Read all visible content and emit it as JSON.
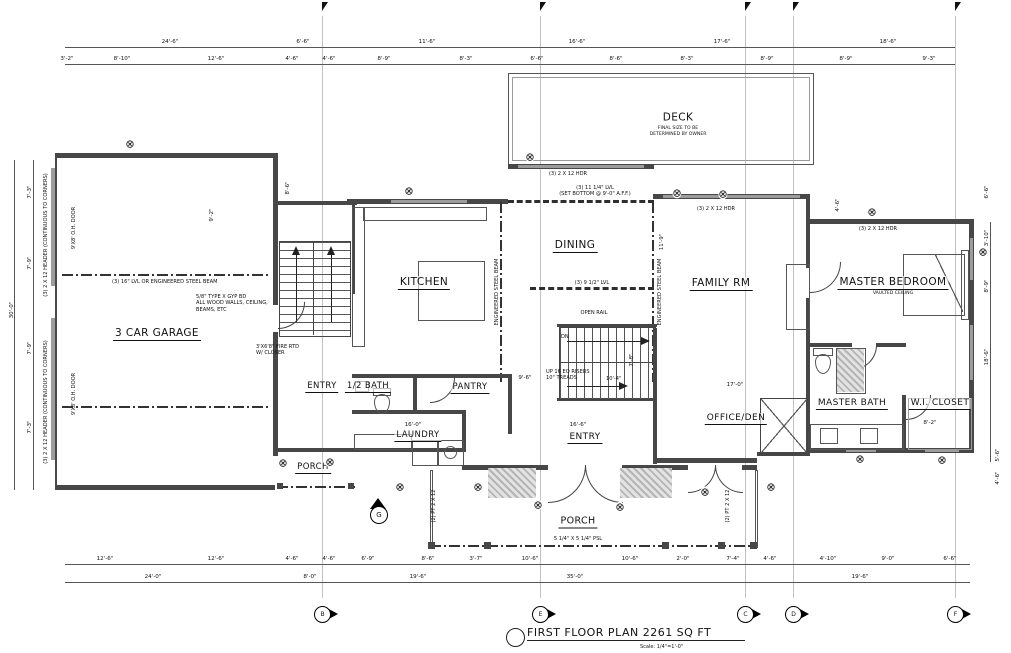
{
  "title_block": {
    "title": "FIRST FLOOR PLAN  2261 SQ FT",
    "scale": "Scale: 1/4\"=1'-0\""
  },
  "rooms": {
    "garage": {
      "label": "3 CAR GARAGE"
    },
    "kitchen": {
      "label": "KITCHEN"
    },
    "dining": {
      "label": "DINING"
    },
    "deck": {
      "label": "DECK",
      "note": "FINAL SIZE TO BE\nDETERMINED BY OWNER"
    },
    "family": {
      "label": "FAMILY RM"
    },
    "master": {
      "label": "MASTER BEDROOM",
      "note": "VAULTED CEILING"
    },
    "master_bath": {
      "label": "MASTER BATH"
    },
    "wic": {
      "label": "W.I. CLOSET"
    },
    "office": {
      "label": "OFFICE/DEN"
    },
    "entry_west": {
      "label": "ENTRY"
    },
    "half_bath": {
      "label": "1/2 BATH"
    },
    "pantry": {
      "label": "PANTRY"
    },
    "laundry": {
      "label": "LAUNDRY"
    },
    "entry_main": {
      "label": "ENTRY"
    },
    "porch_west": {
      "label": "PORCH"
    },
    "porch_south": {
      "label": "PORCH"
    }
  },
  "annotations": [
    {
      "t": "(3) 16\" LVL OR ENGINEERED STEEL BEAM",
      "x": 112,
      "y": 279
    },
    {
      "t": "5/8\" TYPE X GYP BD\nALL WOOD WALLS, CEILING,\nBEAMS, ETC",
      "x": 196,
      "y": 294
    },
    {
      "t": "(3) 11 1/4\" LVL\n(SET BOTTOM @ 9'-0\" A.F.F.)",
      "x": 595,
      "y": 185,
      "c": 1
    },
    {
      "t": "(3) 9 1/2\" LVL",
      "x": 592,
      "y": 280,
      "c": 1
    },
    {
      "t": "(3) 2 X 12 HDR",
      "x": 568,
      "y": 171,
      "c": 1
    },
    {
      "t": "(3) 2 X 12 HDR",
      "x": 716,
      "y": 206,
      "c": 1
    },
    {
      "t": "(3) 2 X 12 HDR",
      "x": 878,
      "y": 226,
      "c": 1
    },
    {
      "t": "OPEN RAIL",
      "x": 594,
      "y": 310,
      "c": 1
    },
    {
      "t": "DN",
      "x": 561,
      "y": 334
    },
    {
      "t": "UP 16 EQ RISERS\n10\" TREADS",
      "x": 546,
      "y": 369
    },
    {
      "t": "10'-4\"",
      "x": 606,
      "y": 376
    },
    {
      "t": "5 1/4\" X 5 1/4\" PSL",
      "x": 578,
      "y": 536,
      "c": 1
    },
    {
      "t": "3'X6'8\" FIRE RTD\nW/ CLOSER",
      "x": 256,
      "y": 344
    },
    {
      "t": "ENGINEERED STEEL BEAM",
      "x": 497,
      "y": 292,
      "v": 1
    },
    {
      "t": "ENGINEERED STEEL BEAM",
      "x": 660,
      "y": 292,
      "v": 1
    },
    {
      "t": "(3) 2 X 12 HEADER (CONTINUOUS TO CORNERS)",
      "x": 46,
      "y": 235,
      "v": 1
    },
    {
      "t": "(3) 2 X 12 HEADER (CONTINUOUS TO CORNERS)",
      "x": 46,
      "y": 402,
      "v": 1
    },
    {
      "t": "9'X8' O.H. DOOR",
      "x": 74,
      "y": 228,
      "v": 1
    },
    {
      "t": "9'X8' O.H. DOOR",
      "x": 74,
      "y": 394,
      "v": 1
    },
    {
      "t": "(2) PT 2 X 12",
      "x": 434,
      "y": 506,
      "v": 1
    },
    {
      "t": "(2) PT 2 X 12",
      "x": 728,
      "y": 506,
      "v": 1
    }
  ],
  "dims": {
    "top_a": [
      {
        "t": "24'-6\"",
        "x": 170,
        "y": 45
      },
      {
        "t": "6'-6\"",
        "x": 303,
        "y": 45
      },
      {
        "t": "11'-6\"",
        "x": 427,
        "y": 45
      },
      {
        "t": "16'-6\"",
        "x": 577,
        "y": 45
      },
      {
        "t": "17'-6\"",
        "x": 722,
        "y": 45
      },
      {
        "t": "18'-6\"",
        "x": 888,
        "y": 45
      }
    ],
    "top_b": [
      {
        "t": "3'-2\"",
        "x": 67,
        "y": 62
      },
      {
        "t": "8'-10\"",
        "x": 122,
        "y": 62
      },
      {
        "t": "12'-6\"",
        "x": 216,
        "y": 62
      },
      {
        "t": "4'-6\"",
        "x": 292,
        "y": 62
      },
      {
        "t": "4'-6\"",
        "x": 329,
        "y": 62
      },
      {
        "t": "8'-9\"",
        "x": 384,
        "y": 62
      },
      {
        "t": "8'-3\"",
        "x": 466,
        "y": 62
      },
      {
        "t": "6'-6\"",
        "x": 537,
        "y": 62
      },
      {
        "t": "8'-6\"",
        "x": 616,
        "y": 62
      },
      {
        "t": "8'-3\"",
        "x": 687,
        "y": 62
      },
      {
        "t": "8'-9\"",
        "x": 767,
        "y": 62
      },
      {
        "t": "8'-9\"",
        "x": 846,
        "y": 62
      },
      {
        "t": "9'-3\"",
        "x": 929,
        "y": 62
      }
    ],
    "bottom_a": [
      {
        "t": "12'-6\"",
        "x": 105,
        "y": 562
      },
      {
        "t": "12'-6\"",
        "x": 216,
        "y": 562
      },
      {
        "t": "4'-6\"",
        "x": 292,
        "y": 562
      },
      {
        "t": "4'-6\"",
        "x": 329,
        "y": 562
      },
      {
        "t": "6'-9\"",
        "x": 368,
        "y": 562
      },
      {
        "t": "8'-6\"",
        "x": 428,
        "y": 562
      },
      {
        "t": "3'-7\"",
        "x": 476,
        "y": 562
      },
      {
        "t": "10'-6\"",
        "x": 530,
        "y": 562
      },
      {
        "t": "10'-6\"",
        "x": 630,
        "y": 562
      },
      {
        "t": "2'-0\"",
        "x": 683,
        "y": 562
      },
      {
        "t": "7'-4\"",
        "x": 733,
        "y": 562
      },
      {
        "t": "4'-6\"",
        "x": 770,
        "y": 562
      },
      {
        "t": "4'-10\"",
        "x": 828,
        "y": 562
      },
      {
        "t": "9'-0\"",
        "x": 888,
        "y": 562
      },
      {
        "t": "6'-6\"",
        "x": 950,
        "y": 562
      }
    ],
    "bottom_b": [
      {
        "t": "24'-0\"",
        "x": 153,
        "y": 580
      },
      {
        "t": "8'-0\"",
        "x": 310,
        "y": 580
      },
      {
        "t": "19'-6\"",
        "x": 418,
        "y": 580
      },
      {
        "t": "35'-0\"",
        "x": 575,
        "y": 580
      },
      {
        "t": "19'-6\"",
        "x": 860,
        "y": 580
      }
    ],
    "left": [
      {
        "t": "7'-3\"",
        "x": 30,
        "y": 192,
        "v": 1
      },
      {
        "t": "7'-9\"",
        "x": 30,
        "y": 263,
        "v": 1
      },
      {
        "t": "7'-9\"",
        "x": 30,
        "y": 348,
        "v": 1
      },
      {
        "t": "7'-3\"",
        "x": 30,
        "y": 427,
        "v": 1
      },
      {
        "t": "30'-0\"",
        "x": 12,
        "y": 310,
        "v": 1
      }
    ],
    "right": [
      {
        "t": "6'-6\"",
        "x": 987,
        "y": 192,
        "v": 1
      },
      {
        "t": "3'-10\"",
        "x": 987,
        "y": 238,
        "v": 1
      },
      {
        "t": "8'-9\"",
        "x": 987,
        "y": 286,
        "v": 1
      },
      {
        "t": "18'-6\"",
        "x": 987,
        "y": 357,
        "v": 1
      },
      {
        "t": "5'-6\"",
        "x": 998,
        "y": 455,
        "v": 1
      },
      {
        "t": "4'-6\"",
        "x": 998,
        "y": 478,
        "v": 1
      }
    ],
    "interior": [
      {
        "t": "17'-0\"",
        "x": 735,
        "y": 388
      },
      {
        "t": "9'-6\"",
        "x": 525,
        "y": 381
      },
      {
        "t": "16'-0\"",
        "x": 413,
        "y": 428
      },
      {
        "t": "16'-6\"",
        "x": 578,
        "y": 428
      },
      {
        "t": "8'-2\"",
        "x": 930,
        "y": 426
      },
      {
        "t": "9'-2\"",
        "x": 212,
        "y": 215,
        "v": 1
      },
      {
        "t": "8'-6\"",
        "x": 288,
        "y": 188,
        "v": 1
      },
      {
        "t": "11'-9\"",
        "x": 662,
        "y": 242,
        "v": 1
      },
      {
        "t": "7'-8\"",
        "x": 632,
        "y": 360,
        "v": 1
      },
      {
        "t": "4'-6\"",
        "x": 838,
        "y": 205,
        "v": 1
      }
    ]
  },
  "windows": [
    [
      130,
      144
    ],
    [
      409,
      191
    ],
    [
      530,
      157
    ],
    [
      677,
      193
    ],
    [
      723,
      194
    ],
    [
      872,
      212
    ],
    [
      983,
      252
    ],
    [
      283,
      463
    ],
    [
      330,
      462
    ],
    [
      400,
      487
    ],
    [
      478,
      487
    ],
    [
      538,
      505
    ],
    [
      620,
      507
    ],
    [
      705,
      492
    ],
    [
      771,
      487
    ],
    [
      860,
      459
    ],
    [
      942,
      460
    ]
  ],
  "grid": {
    "marker_y": 606,
    "markers": [
      {
        "l": "B",
        "x": 322
      },
      {
        "l": "E",
        "x": 540
      },
      {
        "l": "C",
        "x": 745
      },
      {
        "l": "D",
        "x": 793
      },
      {
        "l": "F",
        "x": 955
      }
    ]
  },
  "symbols": {
    "gas": "G",
    "window_glyph": "⊗"
  }
}
